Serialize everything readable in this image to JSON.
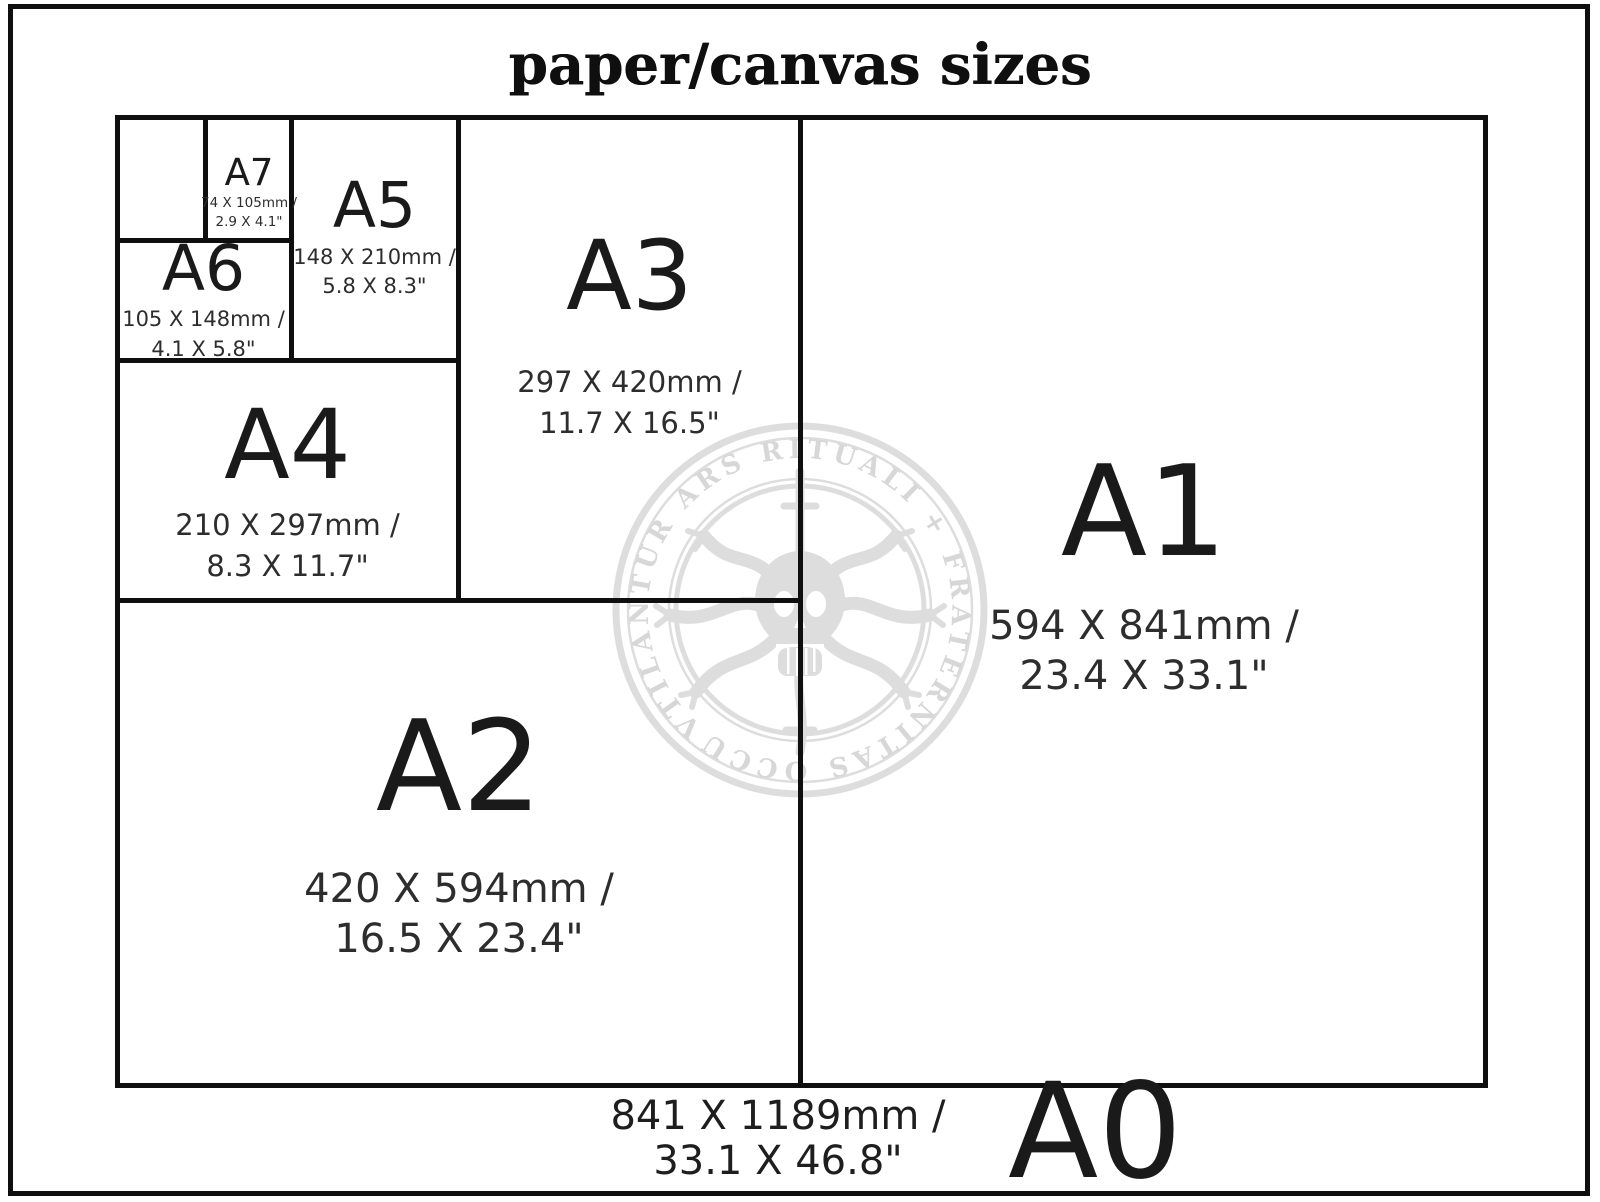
{
  "title": "paper/canvas sizes",
  "colors": {
    "line": "#0f0f0f",
    "label": "#1a1a1a",
    "dims": "#2d2d2d",
    "watermark": "#dcdcdc"
  },
  "watermark": {
    "ring_text": "VTILANTUR ARS RITUALI + FRATERNITAS OCCULTUM +",
    "icon": "skull-tentacles-seal"
  },
  "sizes": {
    "a7": {
      "label": "A7",
      "mm": "74 X 105mm /",
      "inch": "2.9 X 4.1\""
    },
    "a6": {
      "label": "A6",
      "mm": "105 X 148mm /",
      "inch": "4.1 X 5.8\""
    },
    "a5": {
      "label": "A5",
      "mm": "148 X 210mm /",
      "inch": "5.8 X 8.3\""
    },
    "a4": {
      "label": "A4",
      "mm": "210 X 297mm /",
      "inch": "8.3 X 11.7\""
    },
    "a3": {
      "label": "A3",
      "mm": "297 X 420mm /",
      "inch": "11.7 X 16.5\""
    },
    "a2": {
      "label": "A2",
      "mm": "420 X 594mm /",
      "inch": "16.5 X 23.4\""
    },
    "a1": {
      "label": "A1",
      "mm": "594 X 841mm /",
      "inch": "23.4 X 33.1\""
    },
    "a0": {
      "label": "A0",
      "mm": "841 X 1189mm /",
      "inch": "33.1 X 46.8\""
    }
  }
}
